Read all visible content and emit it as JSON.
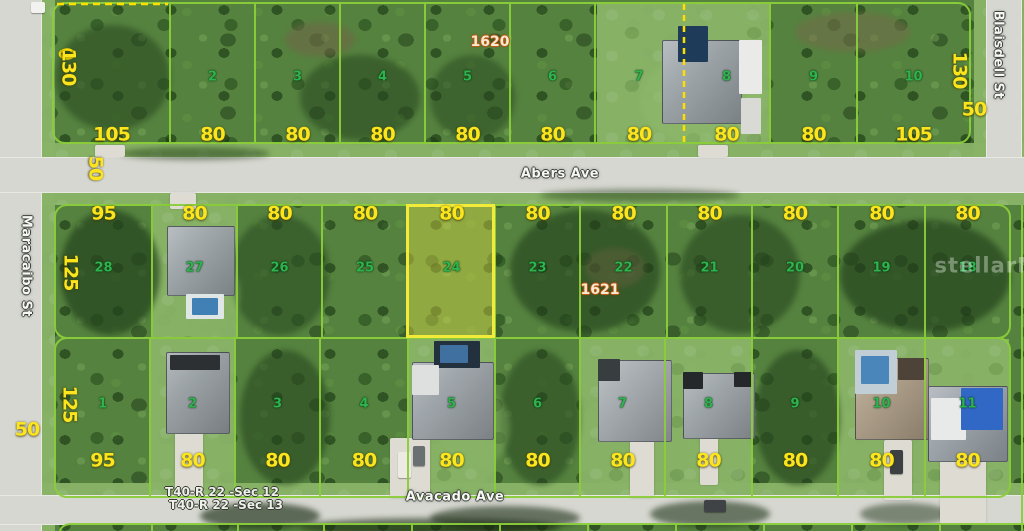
{
  "map": {
    "watermark": "stellarMLS",
    "streets": {
      "abers": "Abers Ave",
      "avacado": "Avacado Ave",
      "maracaibo": "Maracaibo St",
      "blaisdell": "Blaisdell St"
    },
    "parcel_numbers": {
      "north_of_abers": "1620",
      "south_of_abers": "1621"
    },
    "section_lines": [
      "T40-R 22 -Sec 12",
      "T40-R 22 -Sec 13"
    ],
    "road_widths": {
      "abers_at_maracaibo": "50",
      "maracaibo_at_avacado": "50",
      "blaisdell": "50"
    },
    "highlighted_lot": "24",
    "rows": {
      "north": {
        "depth_west": "130",
        "depth_east": "130",
        "lots": [
          {
            "number": "",
            "width": "105"
          },
          {
            "number": "2",
            "width": "80"
          },
          {
            "number": "3",
            "width": "80"
          },
          {
            "number": "4",
            "width": "80"
          },
          {
            "number": "5",
            "width": "80"
          },
          {
            "number": "6",
            "width": "80"
          },
          {
            "number": "7",
            "width": "80"
          },
          {
            "number": "8",
            "width": "80"
          },
          {
            "number": "9",
            "width": "80"
          },
          {
            "number": "10",
            "width": "105"
          }
        ]
      },
      "middle": {
        "depth_west": "125",
        "lots": [
          {
            "number": "28",
            "width": "95"
          },
          {
            "number": "27",
            "width": "80"
          },
          {
            "number": "26",
            "width": "80"
          },
          {
            "number": "25",
            "width": "80"
          },
          {
            "number": "24",
            "width": "80",
            "highlighted": true
          },
          {
            "number": "23",
            "width": "80"
          },
          {
            "number": "22",
            "width": "80"
          },
          {
            "number": "21",
            "width": "80"
          },
          {
            "number": "20",
            "width": "80"
          },
          {
            "number": "19",
            "width": "80"
          },
          {
            "number": "18",
            "width": "80"
          }
        ]
      },
      "south": {
        "depth_west": "125",
        "lots": [
          {
            "number": "1",
            "width": "95"
          },
          {
            "number": "2",
            "width": "80"
          },
          {
            "number": "3",
            "width": "80"
          },
          {
            "number": "4",
            "width": "80"
          },
          {
            "number": "5",
            "width": "80"
          },
          {
            "number": "6",
            "width": "80"
          },
          {
            "number": "7",
            "width": "80"
          },
          {
            "number": "8",
            "width": "80"
          },
          {
            "number": "9",
            "width": "80"
          },
          {
            "number": "10",
            "width": "80"
          },
          {
            "number": "11",
            "width": "80"
          }
        ]
      }
    }
  }
}
